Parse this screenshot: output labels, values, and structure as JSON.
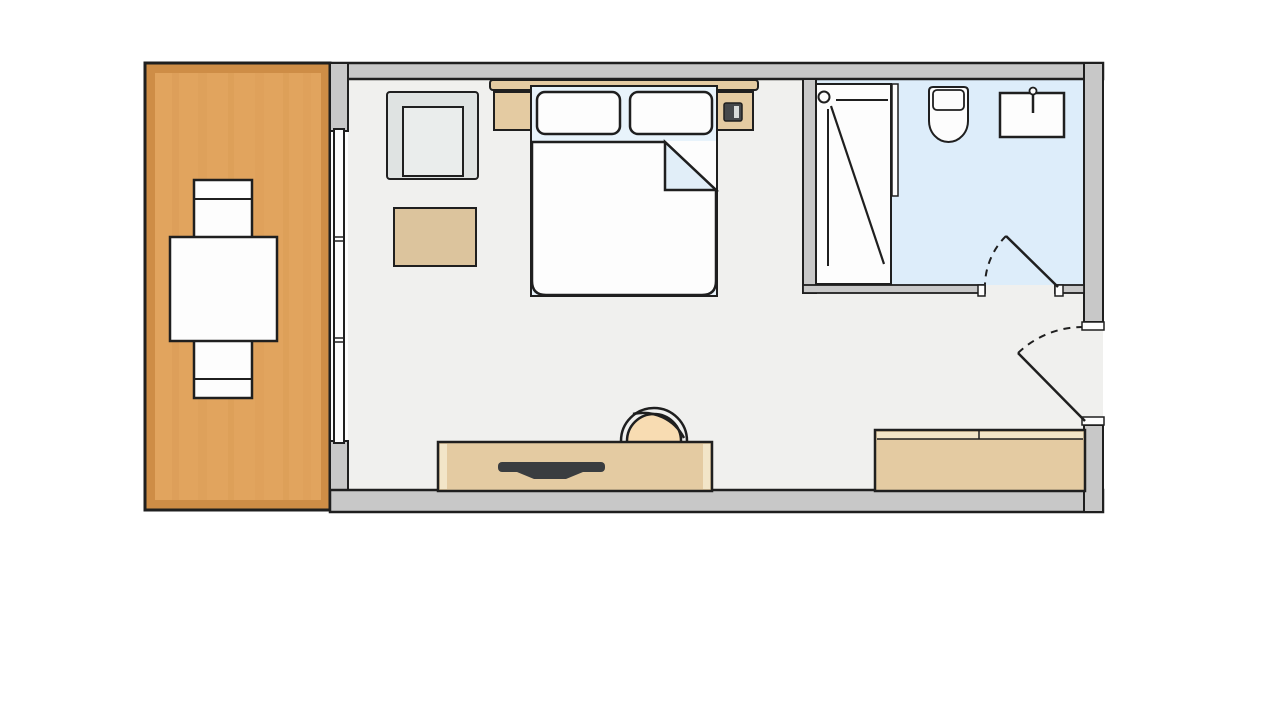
{
  "meta": {
    "type": "floor-plan",
    "scene": "hotel-room-with-balcony-and-bathroom"
  },
  "palette": {
    "canvas": "#ffffff",
    "outline": "#1f1f1f",
    "wall": "#c8c8c8",
    "floor": "#f0f0ee",
    "bath_floor": "#ddedfa",
    "wood": "#e1a45e",
    "wood_border": "#ce8d46",
    "tan": "#e4cba2",
    "tan_light": "#f2e5c8",
    "rug_tan": "#dcc49d",
    "white": "#fdfdfd",
    "bed_base_blue": "#e8f3fb",
    "fold_blue": "#e1eef8",
    "chair_gray": "#dfe3e2",
    "chair_gray_light": "#eaedec",
    "peach": "#f8dcb2",
    "tv_dark": "#3a3d40",
    "phone_dark": "#45484b",
    "phone_light": "#d8dbda"
  },
  "plan": {
    "areas": [
      {
        "id": "balcony",
        "floor": "wood",
        "furniture": [
          "dining-table",
          "chair-top",
          "chair-bottom"
        ]
      },
      {
        "id": "bedroom",
        "floor": "floor",
        "furniture": [
          "armchair",
          "ottoman-rug",
          "headboard",
          "nightstand-left",
          "nightstand-right",
          "telephone",
          "double-bed",
          "pillow-left",
          "pillow-right",
          "duvet-folded-corner",
          "desk-chair",
          "tv-sideboard",
          "tv",
          "wardrobe"
        ]
      },
      {
        "id": "bathroom",
        "floor": "bath_floor",
        "furniture": [
          "shower",
          "shower-head",
          "shower-glass",
          "toilet",
          "sink"
        ]
      }
    ],
    "doors": [
      "bathroom-door-swing",
      "entry-door-swing"
    ],
    "windows": [
      "balcony-window-wall"
    ]
  }
}
